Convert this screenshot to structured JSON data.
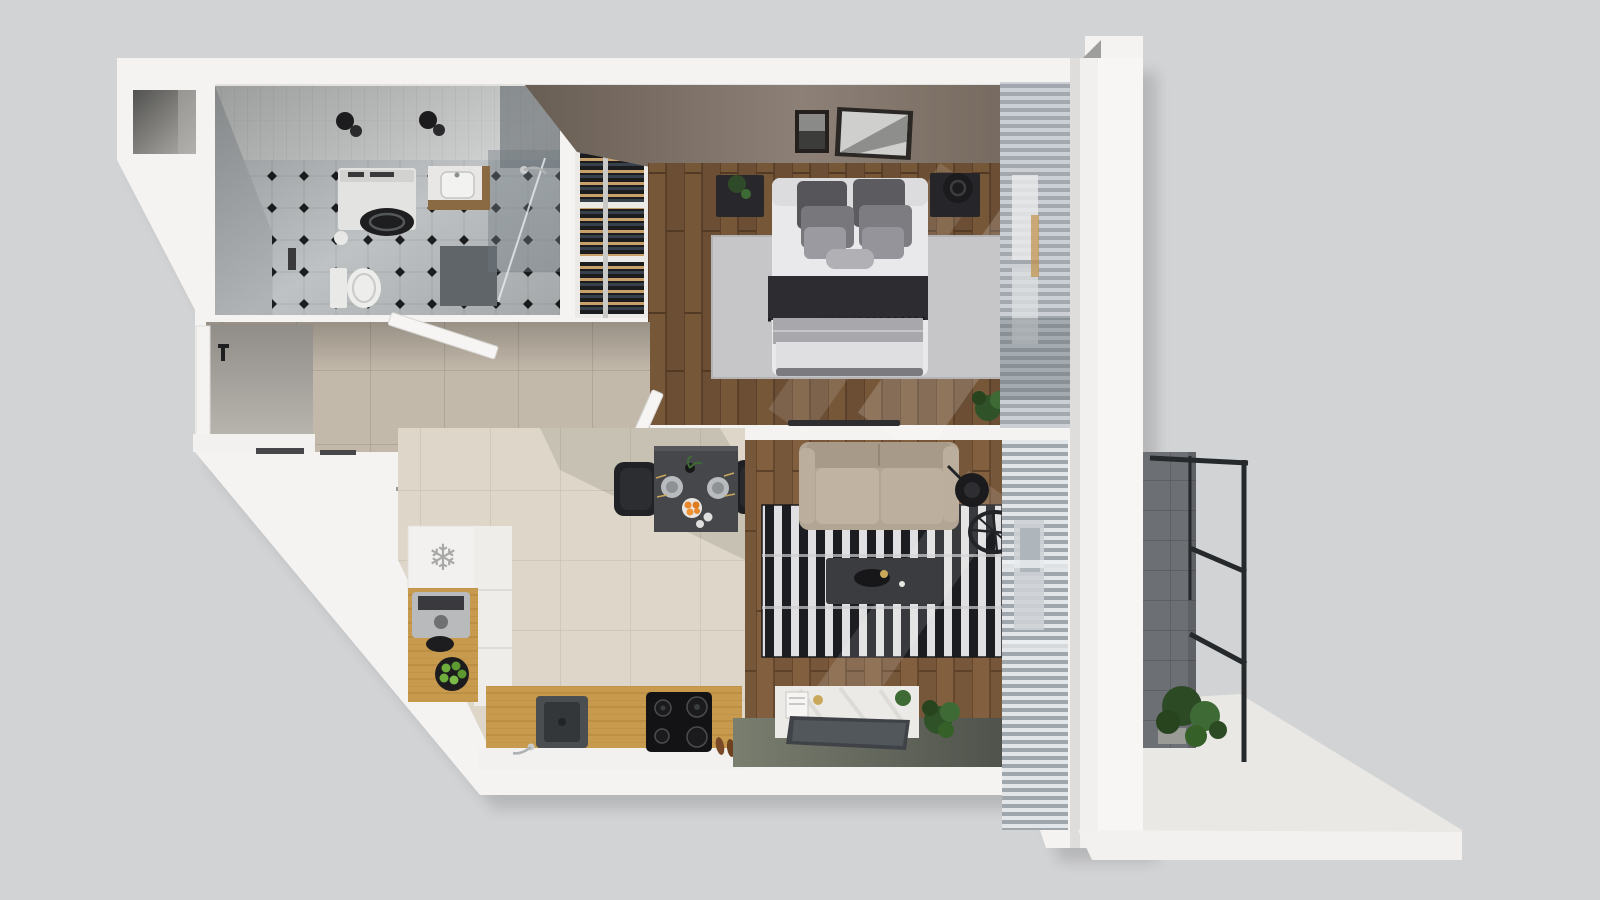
{
  "meta": {
    "title": "3D top-view floor plan render of a one-bedroom apartment with balcony",
    "view": "top-down axonometric render",
    "canvas": {
      "width": 1600,
      "height": 900
    }
  },
  "icons": {
    "snowflake": "❄"
  },
  "colors": {
    "background": "#d2d3d5",
    "wall_white": "#f4f3f1",
    "wall_highlight": "#f7f6f4",
    "wall_shade": "#e2e1de",
    "niche_dark": "#5a5a58",
    "taupe_wall": "#6e6358",
    "bath_floor": "#c8ccce",
    "bath_diamond": "#1f1f21",
    "shower_glass": "#6f7a80",
    "shower_mat": "#5f6568",
    "fixture_white": "#e9e9e7",
    "lamp_black": "#1c1c1e",
    "vanity_wood": "#8a6a42",
    "hall_floor": "#c3b9ab",
    "kitchen_floor": "#ded7c9",
    "bedroom_wood": "#6b4e33",
    "living_wood": "#77573a",
    "bed_white": "#e9e9eb",
    "pillow_dark": "#55555a",
    "pillow_mid": "#77777c",
    "pillow_light": "#9a9aa0",
    "blanket_dark": "#2d2d31",
    "duvet_gray": "#a8a8ac",
    "bedroom_rug": "#c6c6c8",
    "nightstand_black": "#28282c",
    "rug_stripe_black": "#1c1d21",
    "rug_stripe_white": "#e0e0e2",
    "sofa_beige": "#b3a593",
    "sofa_cushion": "#c1b3a1",
    "coffee_table": "#3b3c40",
    "dining_table": "#46474b",
    "chair_black": "#212225",
    "orange_fruit": "#e8872b",
    "apple_green": "#6fae3d",
    "counter_wood": "#c79a4e",
    "hob_black": "#131316",
    "sink_steel": "#4b4e51",
    "steel_silver": "#b9babc",
    "sideboard_white": "#eceae7",
    "tv_panel": "#3f4247",
    "olive_floor": "#6e7264",
    "curtain_light": "#ccd0d4",
    "curtain_dark": "#a2a8ae",
    "blind_light": "#e3e6e8",
    "blind_dark": "#9fa6ac",
    "balcony_tile": "#6c7074",
    "railing_black": "#26292b",
    "terrace_floor": "#e9e8e4",
    "plant_green": "#3e6b35",
    "plant_dark": "#27441f",
    "clothes_navy": "#2c3950",
    "clothes_tan": "#b08d5a",
    "shelf_slat_tan": "#c9a06a",
    "shelf_slat_blue": "#38404c"
  },
  "rooms": [
    {
      "id": "bathroom",
      "label": "Bathroom",
      "furniture": [
        "washing-machine",
        "vanity-sink",
        "toilet",
        "toilet-paper-roll",
        "shower-enclosure",
        "shower-mat",
        "ceiling-lamps"
      ]
    },
    {
      "id": "hallway",
      "label": "Hallway / entry",
      "furniture": [
        "entry-door",
        "door-handle",
        "doormats",
        "bathroom-door-leaf",
        "bedroom-door-leaf",
        "open-wardrobe-with-hangers"
      ]
    },
    {
      "id": "storage-cabinet",
      "label": "Slatted shelf cabinet",
      "furniture": [
        "shelf-bays",
        "cabinet-door"
      ]
    },
    {
      "id": "bedroom",
      "label": "Bedroom",
      "furniture": [
        "double-bed",
        "pillows",
        "throw-blanket",
        "area-rug",
        "nightstand-left",
        "nightstand-right",
        "table-lamp",
        "wall-pictures",
        "floor-plant",
        "window-curtains"
      ]
    },
    {
      "id": "kitchen",
      "label": "Kitchen",
      "furniture": [
        "fridge-cabinet",
        "snowflake-mark",
        "coffee-machine",
        "fruit-plate",
        "wood-counter",
        "sink",
        "faucet",
        "cooktop",
        "slippers"
      ]
    },
    {
      "id": "dining",
      "label": "Dining nook",
      "furniture": [
        "dining-table",
        "chair-left",
        "chair-right",
        "plates",
        "orange-bowl",
        "cutlery",
        "vase"
      ]
    },
    {
      "id": "living-room",
      "label": "Living room",
      "furniture": [
        "sofa",
        "floor-lamp",
        "wheel-decor",
        "striped-rug",
        "coffee-table",
        "media-sideboard",
        "tv-panel",
        "plants",
        "window-blinds"
      ]
    },
    {
      "id": "loggia",
      "label": "Loggia (olive floor strip)",
      "furniture": [
        "media-wall"
      ]
    },
    {
      "id": "balcony",
      "label": "Balcony / terrace",
      "furniture": [
        "tiled-pillar",
        "metal-railing",
        "potted-plant",
        "terrace-floor"
      ]
    }
  ]
}
